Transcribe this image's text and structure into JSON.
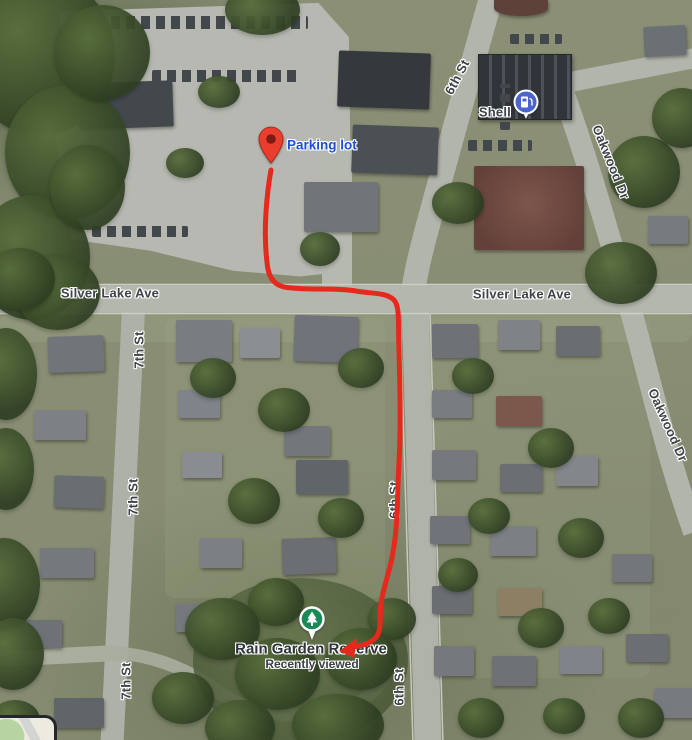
{
  "map_labels": {
    "silver_lake_ave_west": "Silver Lake Ave",
    "silver_lake_ave_east": "Silver Lake Ave",
    "sixth_st_top": "6th St",
    "sixth_st_mid": "6th St",
    "sixth_st_bottom": "6th St",
    "seventh_st_upper": "7th St",
    "seventh_st_mid": "7th St",
    "seventh_st_lower": "7th St",
    "oakwood_dr_top": "Oakwood Dr",
    "oakwood_dr_mid": "Oakwood Dr"
  },
  "markers": {
    "parking": {
      "label": "Parking lot",
      "icon": "red-pin-icon"
    },
    "shell": {
      "label": "Shell",
      "icon": "gas-pump-icon"
    },
    "rain_garden": {
      "title": "Rain Garden Reserve",
      "subtitle": "Recently viewed",
      "icon": "park-tree-icon"
    }
  },
  "route": {
    "color": "#e5291d"
  },
  "colors": {
    "pin_red": "#e93d2e",
    "pin_inner": "#7e1a12",
    "park_green": "#178a56",
    "gas_blue": "#4d64cc",
    "parking_label_blue": "#1b4fd6",
    "road_gray": "#b4b7ae"
  }
}
